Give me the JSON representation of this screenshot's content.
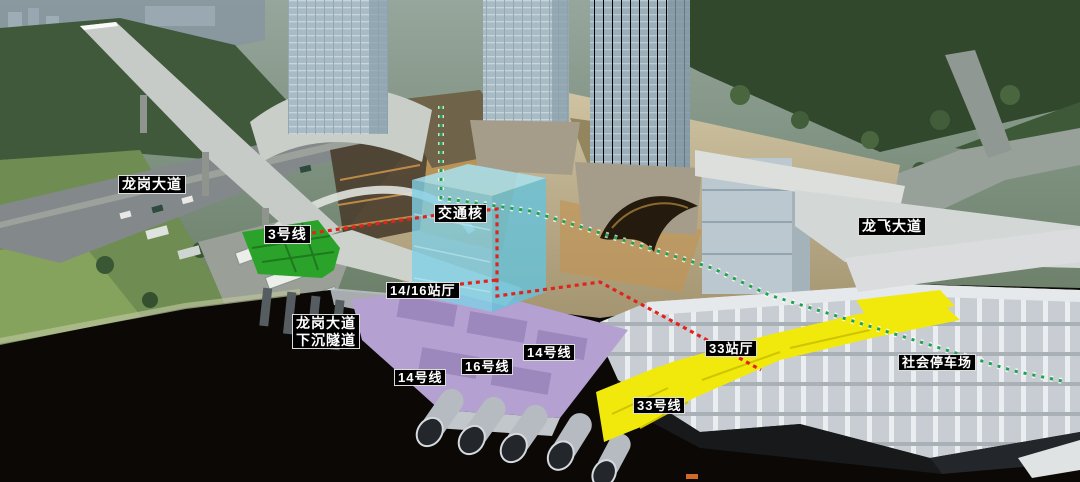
{
  "scene": {
    "type": "3d-aerial-cutaway-rendering",
    "description": "Aerial cutaway rendering of a transit hub: towers above ground, metro line platforms, transport core and parking highlighted underground"
  },
  "colors": {
    "line3_green": "#2ba32a",
    "transport_core_cyan": "#7fd0e6",
    "line14_16_purple": "#b4a0d1",
    "line33_yellow": "#f1e90c",
    "route_red": "#e0241c",
    "route_green": "#1ea24d",
    "label_bg": "#000000",
    "label_text": "#ffffff"
  },
  "labels": {
    "longgang_avenue": "龙岗大道",
    "line3": "3号线",
    "transport_core": "交通核",
    "hall_14_16": "14/16站厅",
    "sunken_tunnel_line1": "龙岗大道",
    "sunken_tunnel_line2": "下沉隧道",
    "line14_left": "14号线",
    "line16": "16号线",
    "line14_right": "14号线",
    "hall_33": "33站厅",
    "line33": "33号线",
    "longfei_avenue": "龙飞大道",
    "public_parking": "社会停车场"
  }
}
